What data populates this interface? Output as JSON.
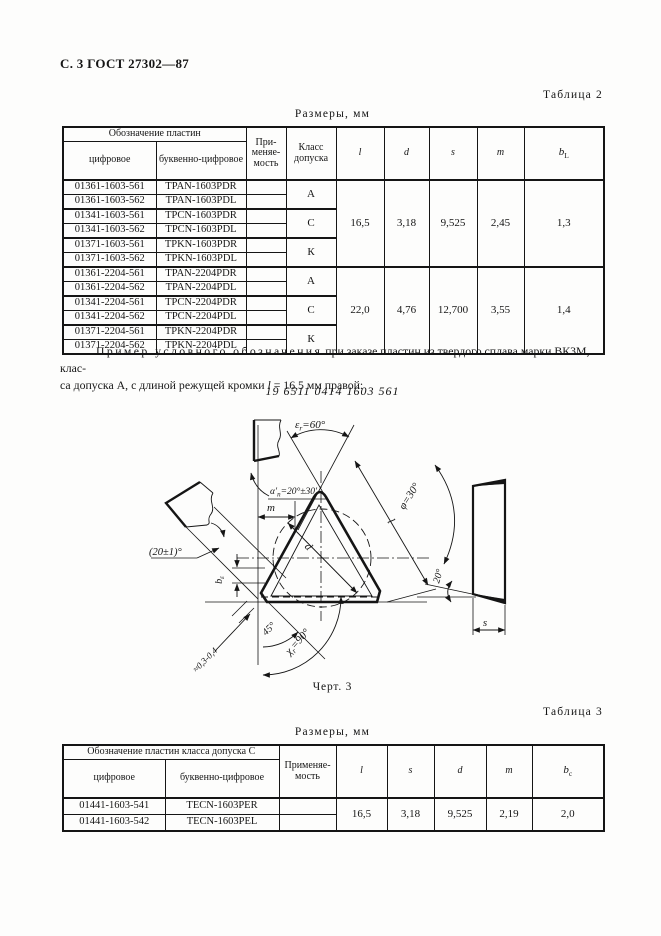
{
  "page": {
    "header": "С. 3 ГОСТ 27302—87"
  },
  "table2": {
    "caption": "Таблица 2",
    "units": "Размеры, мм",
    "head": {
      "designation": "Обозначение пластин",
      "numeric": "цифровое",
      "alnum": "буквенно-цифровое",
      "usage": "При-меняе-мость",
      "klass": "Класс допуска",
      "l": "l",
      "d": "d",
      "s": "s",
      "m": "m",
      "b": "b",
      "bsub": "L"
    },
    "classes": [
      "А",
      "С",
      "К",
      "А",
      "С",
      "К"
    ],
    "rows": [
      {
        "num": "01361-1603-561",
        "code": "TPAN-1603PDR"
      },
      {
        "num": "01361-1603-562",
        "code": "TPAN-1603PDL"
      },
      {
        "num": "01341-1603-561",
        "code": "TPCN-1603PDR"
      },
      {
        "num": "01341-1603-562",
        "code": "TPCN-1603PDL"
      },
      {
        "num": "01371-1603-561",
        "code": "TPKN-1603PDR"
      },
      {
        "num": "01371-1603-562",
        "code": "TPKN-1603PDL"
      },
      {
        "num": "01361-2204-561",
        "code": "TPAN-2204PDR"
      },
      {
        "num": "01361-2204-562",
        "code": "TPAN-2204PDL"
      },
      {
        "num": "01341-2204-561",
        "code": "TPCN-2204PDR"
      },
      {
        "num": "01341-2204-562",
        "code": "TPCN-2204PDL"
      },
      {
        "num": "01371-2204-561",
        "code": "TPKN-2204PDR"
      },
      {
        "num": "01371-2204-562",
        "code": "TPKN-2204PDL"
      }
    ],
    "block1": {
      "l": "16,5",
      "d": "3,18",
      "s": "9,525",
      "m": "2,45",
      "bL": "1,3"
    },
    "block2": {
      "l": "22,0",
      "d": "4,76",
      "s": "12,700",
      "m": "3,55",
      "bL": "1,4"
    }
  },
  "example": {
    "lead": "Пример условного обозначения",
    "line1_rest": " при заказе пластин из твердого сплава марки ВК3М, клас-",
    "line2_pre": "са допуска А, с длиной режущей кромки ",
    "var": "l",
    "line2_post": " = 16,5 мм правой:",
    "code": "19 6511 0414 1603 561"
  },
  "drawing": {
    "caption": "Черт. 3",
    "eps": {
      "sym": "ε",
      "sub": "r",
      "val": "=60°"
    },
    "alpha": {
      "sym": "α′",
      "sub": "n",
      "val": "=20°±30′"
    },
    "phi": "φ=30°",
    "l": "l",
    "d": "d",
    "m": "m",
    "s": "s",
    "beps": {
      "sym": "b",
      "sub": "ε"
    },
    "kappa": {
      "sym": "χ",
      "sub": "r",
      "val": "=90°"
    },
    "a45": "45°",
    "a20": "20°",
    "a20pm": "(20±1)°",
    "chamfer": "≈0,3-0,4"
  },
  "table3": {
    "caption": "Таблица 3",
    "units": "Размеры, мм",
    "head": {
      "designation": "Обозначение пластин класса допуска С",
      "numeric": "цифровое",
      "alnum": "буквенно-цифровое",
      "usage": "Применяе-мость",
      "l": "l",
      "s": "s",
      "d": "d",
      "m": "m",
      "b": "b",
      "bsub": "c"
    },
    "rows": [
      {
        "num": "01441-1603-541",
        "code": "TECN-1603PER"
      },
      {
        "num": "01441-1603-542",
        "code": "TECN-1603PEL"
      }
    ],
    "values": {
      "l": "16,5",
      "s": "3,18",
      "d": "9,525",
      "m": "2,19",
      "bc": "2,0"
    }
  }
}
